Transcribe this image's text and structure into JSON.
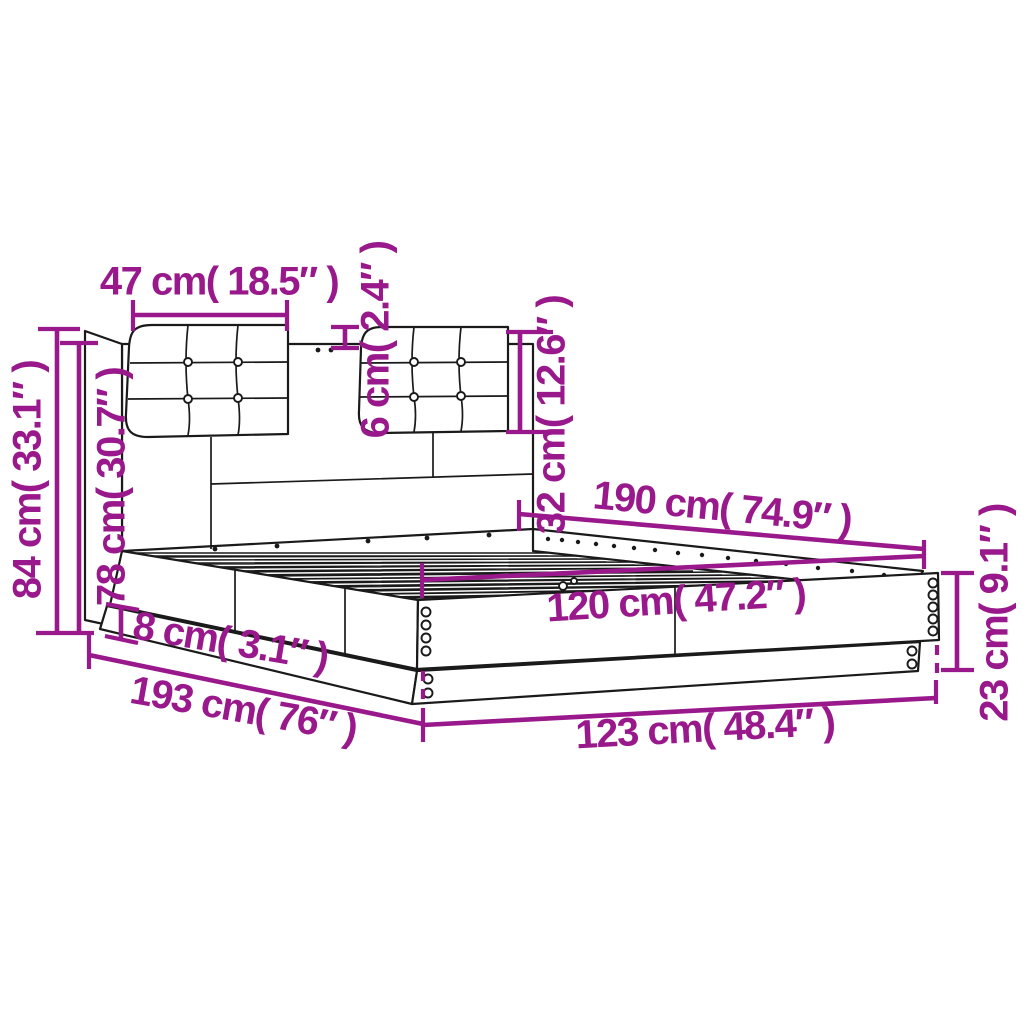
{
  "diagram": {
    "title": "Bed frame with headboard and cushions — dimension diagram",
    "accent_color": "#99188B",
    "outline_color": "#1a1a1a",
    "background_color": "#ffffff",
    "dimensions": {
      "cushion_width": "47 cm( 18.5″ )",
      "cushion_gap_depth": "6 cm( 2.4″ )",
      "cushion_height": "32 cm( 12.6″ )",
      "headboard_height_total": "84 cm( 33.1″ )",
      "headboard_height_panel": "78 cm( 30.7″ )",
      "length_inner": "190 cm( 74.9″ )",
      "width_inner": "120 cm( 47.2″ )",
      "plinth_height": "8 cm( 3.1″ )",
      "length_outer": "193 cm( 76″ )",
      "width_outer": "123 cm( 48.4″ )",
      "frame_height": "23 cm( 9.1″ )"
    }
  }
}
